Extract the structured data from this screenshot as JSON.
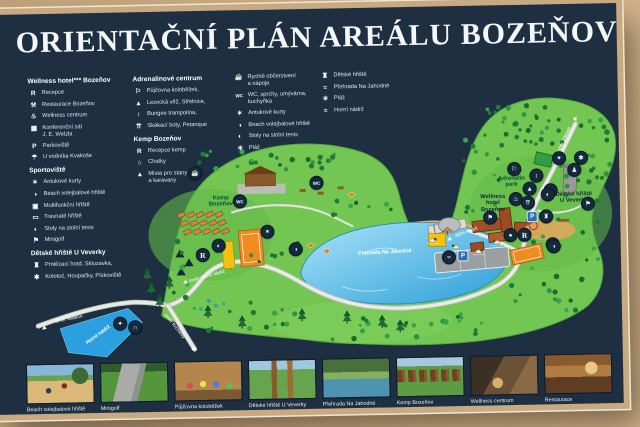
{
  "title": "ORIENTAČNÍ PLÁN AREÁLU BOZEŇOV",
  "colors": {
    "board_navy": "#1d2f41",
    "frame_tan": "#c9ab84",
    "frame_line": "#f0e6d2",
    "map_green": "#74c653",
    "lake_blue": "#2d9fd8",
    "parking_blue": "#2e6db4"
  },
  "legend": {
    "columns": [
      {
        "sections": [
          {
            "heading": "Wellness hotel*** Bozeňov",
            "items": [
              {
                "icon": "reception-icon",
                "glyph": "R",
                "label": "Recepce"
              },
              {
                "icon": "restaurant-icon",
                "glyph": "⚒",
                "label": "Restaurace Bozeňov"
              },
              {
                "icon": "wellness-icon",
                "glyph": "♨",
                "label": "Wellness centrum"
              },
              {
                "icon": "conference-icon",
                "glyph": "▦",
                "label": "Konferenční sál\nJ. E. Welzla"
              },
              {
                "icon": "parking-icon",
                "glyph": "P",
                "label": "Parkoviště"
              },
              {
                "icon": "waterman-icon",
                "glyph": "☂",
                "label": "U vodníka Kvakoše"
              }
            ]
          },
          {
            "heading": "Sportoviště",
            "items": [
              {
                "icon": "clay-court-icon",
                "glyph": "✶",
                "label": "Antukové kurty"
              },
              {
                "icon": "beach-volleyball-icon",
                "glyph": "◑",
                "label": "Beach volejbalové hřiště"
              },
              {
                "icon": "multisport-icon",
                "glyph": "▣",
                "label": "Multifunkční hřiště"
              },
              {
                "icon": "grass-field-icon",
                "glyph": "▭",
                "label": "Travnaté hřiště"
              },
              {
                "icon": "table-tennis-icon",
                "glyph": "◐",
                "label": "Stoly na stolní tenis"
              },
              {
                "icon": "minigolf-icon",
                "glyph": "⚑",
                "label": "Minigolf"
              }
            ]
          },
          {
            "heading": "Dětské hřiště U Veverky",
            "items": [
              {
                "icon": "climbing-castle-icon",
                "glyph": "♜",
                "label": "Prolézací hrad, Skluzavka,"
              },
              {
                "icon": "carousel-icon",
                "glyph": "✱",
                "label": "Kolotoč, Houpačky, Pískoviště"
              }
            ]
          }
        ]
      },
      {
        "sections": [
          {
            "heading": "Adrenalinové centrum",
            "items": [
              {
                "icon": "scooter-icon",
                "glyph": "⚐",
                "label": "Půjčovna koloběžek,"
              },
              {
                "icon": "climbing-wall-icon",
                "glyph": "▲",
                "label": "Lezecká věž, Střelnice,"
              },
              {
                "icon": "bungee-icon",
                "glyph": "↕",
                "label": "Bungee trampolína,"
              },
              {
                "icon": "jump-boots-icon",
                "glyph": "⇈",
                "label": "Skákací boty, Petanque"
              }
            ]
          },
          {
            "heading": "Kemp Bozeňov",
            "items": [
              {
                "icon": "camp-reception-icon",
                "glyph": "R",
                "label": "Recepce kemp"
              },
              {
                "icon": "cabins-icon",
                "glyph": "⌂",
                "label": "Chatky"
              },
              {
                "icon": "tents-icon",
                "glyph": "▲",
                "label": "Místa pro stany\na karavany"
              }
            ]
          }
        ]
      },
      {
        "sections": [
          {
            "heading": "",
            "items": [
              {
                "icon": "refreshments-icon",
                "glyph": "☕",
                "label": "Rychlé občerstvení\na nápoje"
              },
              {
                "icon": "wc-icon",
                "glyph": "WC",
                "label": "WC, sprchy, umývárna,\nkuchyňka"
              },
              {
                "icon": "clay-court-icon",
                "glyph": "✶",
                "label": "Antukové kurty"
              },
              {
                "icon": "beach-volleyball-icon",
                "glyph": "◑",
                "label": "Beach volejbalové hřiště"
              },
              {
                "icon": "table-tennis-icon",
                "glyph": "◐",
                "label": "Stoly na stolní tenis"
              },
              {
                "icon": "beach-icon",
                "glyph": "☀",
                "label": "Pláž"
              }
            ]
          }
        ]
      },
      {
        "sections": [
          {
            "heading": "",
            "items": [
              {
                "icon": "playground-icon",
                "glyph": "♜",
                "label": "Dětské hřiště"
              },
              {
                "icon": "reservoir-icon",
                "glyph": "≈",
                "label": "Přehrada Na Jahodné"
              },
              {
                "icon": "beach-icon",
                "glyph": "☀",
                "label": "Pláž"
              },
              {
                "icon": "upper-reservoir-icon",
                "glyph": "≈",
                "label": "Horní nádrž"
              }
            ]
          }
        ]
      }
    ]
  },
  "map": {
    "area_labels": [
      {
        "text": "Kemp\nBozeňov",
        "x": 221,
        "y": 197,
        "color": "#0a4f2e"
      },
      {
        "text": "Adrenalin\npark",
        "x": 512,
        "y": 183,
        "color": "#0a4f2e"
      },
      {
        "text": "Wellness\nhotel\nBozeňov",
        "x": 493,
        "y": 204,
        "color": "#10293d"
      },
      {
        "text": "Dětské hřiště\nU Veverky",
        "x": 574,
        "y": 200,
        "color": "#10293d"
      }
    ],
    "water_labels": [
      {
        "text": "Přehrada Na Jahodné",
        "x": 384,
        "y": 251,
        "rot": -2
      },
      {
        "text": "Horní nádrž",
        "x": 96,
        "y": 328,
        "rot": -35
      }
    ],
    "road_labels": [
      {
        "text": "směr Maletín",
        "x": 67,
        "y": 312,
        "rot": -10,
        "ax": 42,
        "ay": 320,
        "arot": -125
      },
      {
        "text": "směr Krchleby",
        "x": 172,
        "y": 321,
        "rot": 52,
        "ax": 191,
        "ay": 344,
        "arot": 145
      },
      {
        "text": "směr Horní nádrž",
        "x": 206,
        "y": 272,
        "rot": -14,
        "ax": 184,
        "ay": 277,
        "arot": -115
      },
      {
        "text": "směr Zábřeh",
        "x": 566,
        "y": 142,
        "rot": -63,
        "ax": 577,
        "ay": 121,
        "arot": 30
      },
      {
        "text": "dolní nádrž",
        "x": 466,
        "y": 233,
        "rot": -18,
        "ax": 449,
        "ay": 239,
        "arot": -120
      }
    ],
    "markers": [
      {
        "x": 196,
        "y": 168,
        "g": "☕",
        "n": "refreshments-marker"
      },
      {
        "x": 240,
        "y": 197,
        "g": "WC",
        "n": "wc-marker"
      },
      {
        "x": 317,
        "y": 180,
        "g": "WC",
        "n": "wc-showers-marker"
      },
      {
        "x": 218,
        "y": 241,
        "g": "◐",
        "n": "table-tennis-marker"
      },
      {
        "x": 295,
        "y": 246,
        "g": "◑",
        "n": "beach-volleyball-marker"
      },
      {
        "x": 267,
        "y": 228,
        "g": "✶",
        "n": "clay-court-marker"
      },
      {
        "x": 202,
        "y": 250,
        "g": "R",
        "n": "camp-reception-marker"
      },
      {
        "x": 448,
        "y": 257,
        "g": "≈",
        "n": "swimming-marker"
      },
      {
        "x": 515,
        "y": 170,
        "g": "⚐",
        "n": "scooter-rental-marker"
      },
      {
        "x": 537,
        "y": 177,
        "g": "↕",
        "n": "bungee-marker"
      },
      {
        "x": 530,
        "y": 190,
        "g": "▲",
        "n": "climbing-wall-marker"
      },
      {
        "x": 551,
        "y": 192,
        "g": "◐",
        "n": "table-tennis-marker"
      },
      {
        "x": 516,
        "y": 200,
        "g": "♨",
        "n": "wellness-marker"
      },
      {
        "x": 528,
        "y": 204,
        "g": "⇈",
        "n": "jump-boots-marker"
      },
      {
        "x": 490,
        "y": 218,
        "g": "⚑",
        "n": "minigolf-marker"
      },
      {
        "x": 510,
        "y": 236,
        "g": "●",
        "n": "petanque-marker"
      },
      {
        "x": 524,
        "y": 236,
        "g": "R",
        "n": "hotel-reception-marker"
      },
      {
        "x": 552,
        "y": 246,
        "g": "☕",
        "n": "restaurant-marker"
      },
      {
        "x": 560,
        "y": 160,
        "g": "✦",
        "n": "playground-marker"
      },
      {
        "x": 582,
        "y": 160,
        "g": "✱",
        "n": "carousel-marker"
      },
      {
        "x": 575,
        "y": 172,
        "g": "♟",
        "n": "swings-marker"
      },
      {
        "x": 548,
        "y": 196,
        "g": "◐",
        "n": "table-tennis-marker"
      },
      {
        "x": 588,
        "y": 206,
        "g": "⚑",
        "n": "minigolf-marker"
      },
      {
        "x": 553,
        "y": 248,
        "g": "◑",
        "n": "beach-volleyball-marker"
      },
      {
        "x": 546,
        "y": 218,
        "g": "♜",
        "n": "climbing-castle-marker"
      },
      {
        "x": 118,
        "y": 317,
        "g": "✦",
        "n": "rest-area-marker"
      },
      {
        "x": 133,
        "y": 321,
        "g": "∩",
        "n": "bench-marker"
      }
    ],
    "parking_markers": [
      {
        "x": 532,
        "y": 218
      },
      {
        "x": 462,
        "y": 256
      }
    ]
  },
  "photos": [
    {
      "label": "Beach volejbalové hřiště",
      "art": "beach",
      "name": "photo-beach-volleyball"
    },
    {
      "label": "Minigolf",
      "art": "minigolf",
      "name": "photo-minigolf"
    },
    {
      "label": "Půjčovna koloběžek",
      "art": "scooters",
      "name": "photo-scooter-rental"
    },
    {
      "label": "Dětské hřiště U Veverky",
      "art": "playground",
      "name": "photo-playground"
    },
    {
      "label": "Přehrada Na Jahodné",
      "art": "lake",
      "name": "photo-reservoir"
    },
    {
      "label": "Kemp Bozeňov",
      "art": "camp",
      "name": "photo-camp"
    },
    {
      "label": "Wellness centrum",
      "art": "wellness",
      "name": "photo-wellness"
    },
    {
      "label": "Restaurace",
      "art": "restaurant",
      "name": "photo-restaurant"
    }
  ]
}
